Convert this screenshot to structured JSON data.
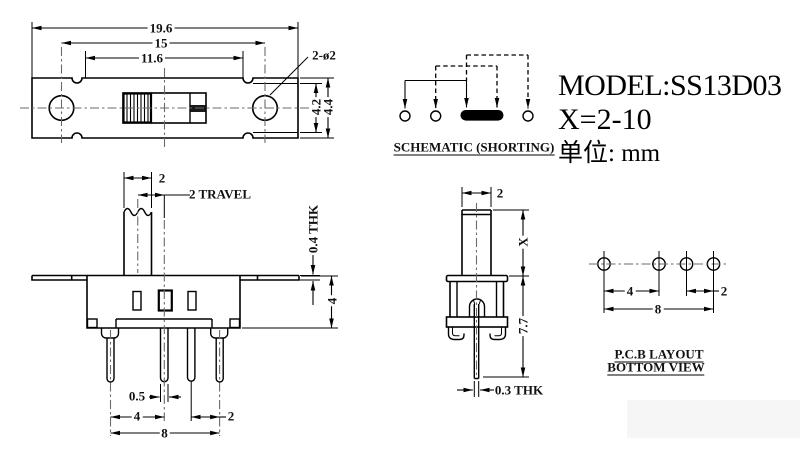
{
  "title_block": {
    "model": "MODEL:SS13D03",
    "x_range": "X=2-10",
    "units": "单位: mm"
  },
  "top_view": {
    "dim_overall_length": "19.6",
    "dim_hole_spacing": "15",
    "dim_window_length": "11.6",
    "dim_hole_callout": "2-ø2",
    "dim_height_inner": "4.2",
    "dim_height_outer": "4.4"
  },
  "schematic": {
    "caption": "SCHEMATIC (SHORTING)"
  },
  "front_view": {
    "dim_knob_width": "2",
    "dim_travel": "2 TRAVEL",
    "dim_flange_thickness": "0.4 THK",
    "dim_body_height": "4",
    "dim_pin_width": "0.5",
    "dim_pin_pitch_left": "4",
    "dim_pin_pitch_right": "2",
    "dim_pin_span": "8"
  },
  "side_view": {
    "dim_knob_depth": "2",
    "dim_stem_height": "X",
    "dim_total_height": "7.7",
    "dim_pin_thickness": "0.3 THK"
  },
  "pcb_layout": {
    "caption_line1": "P.C.B LAYOUT",
    "caption_line2": "BOTTOM VIEW",
    "dim_pitch_left": "4",
    "dim_pitch_right": "2",
    "dim_span": "8"
  }
}
